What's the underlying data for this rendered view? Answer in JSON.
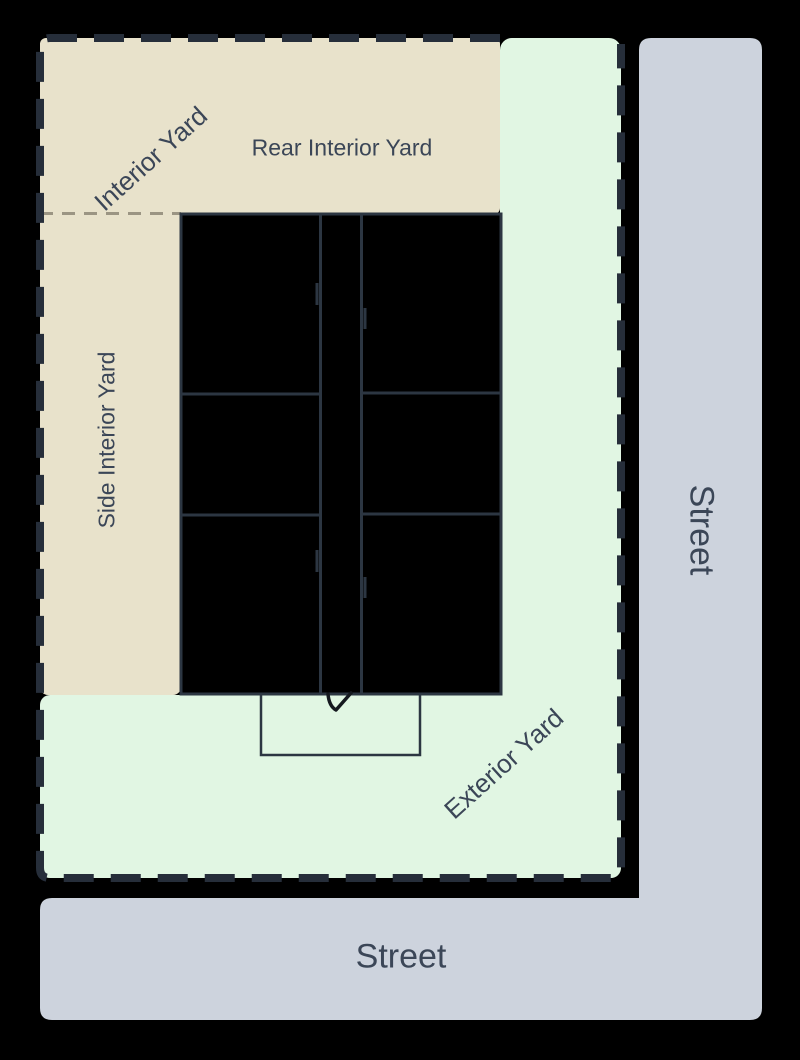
{
  "diagram": {
    "labels": {
      "interior_yard": "Interior Yard",
      "rear_interior_yard": "Rear Interior Yard",
      "side_interior_yard": "Side Interior Yard",
      "exterior_yard": "Exterior Yard",
      "street_right": "Street",
      "street_bottom": "Street"
    },
    "colors": {
      "background": "#000000",
      "interior_yard_fill": "#e8e2cb",
      "exterior_yard_fill": "#e1f6e3",
      "street_fill": "#cdd3dd",
      "building_fill": "#000000",
      "building_line": "#2c3642",
      "lot_boundary": "#262e3a",
      "yard_divider": "#9b9583",
      "door_symbol": "#15191f",
      "label_text": "#3b4657"
    }
  }
}
